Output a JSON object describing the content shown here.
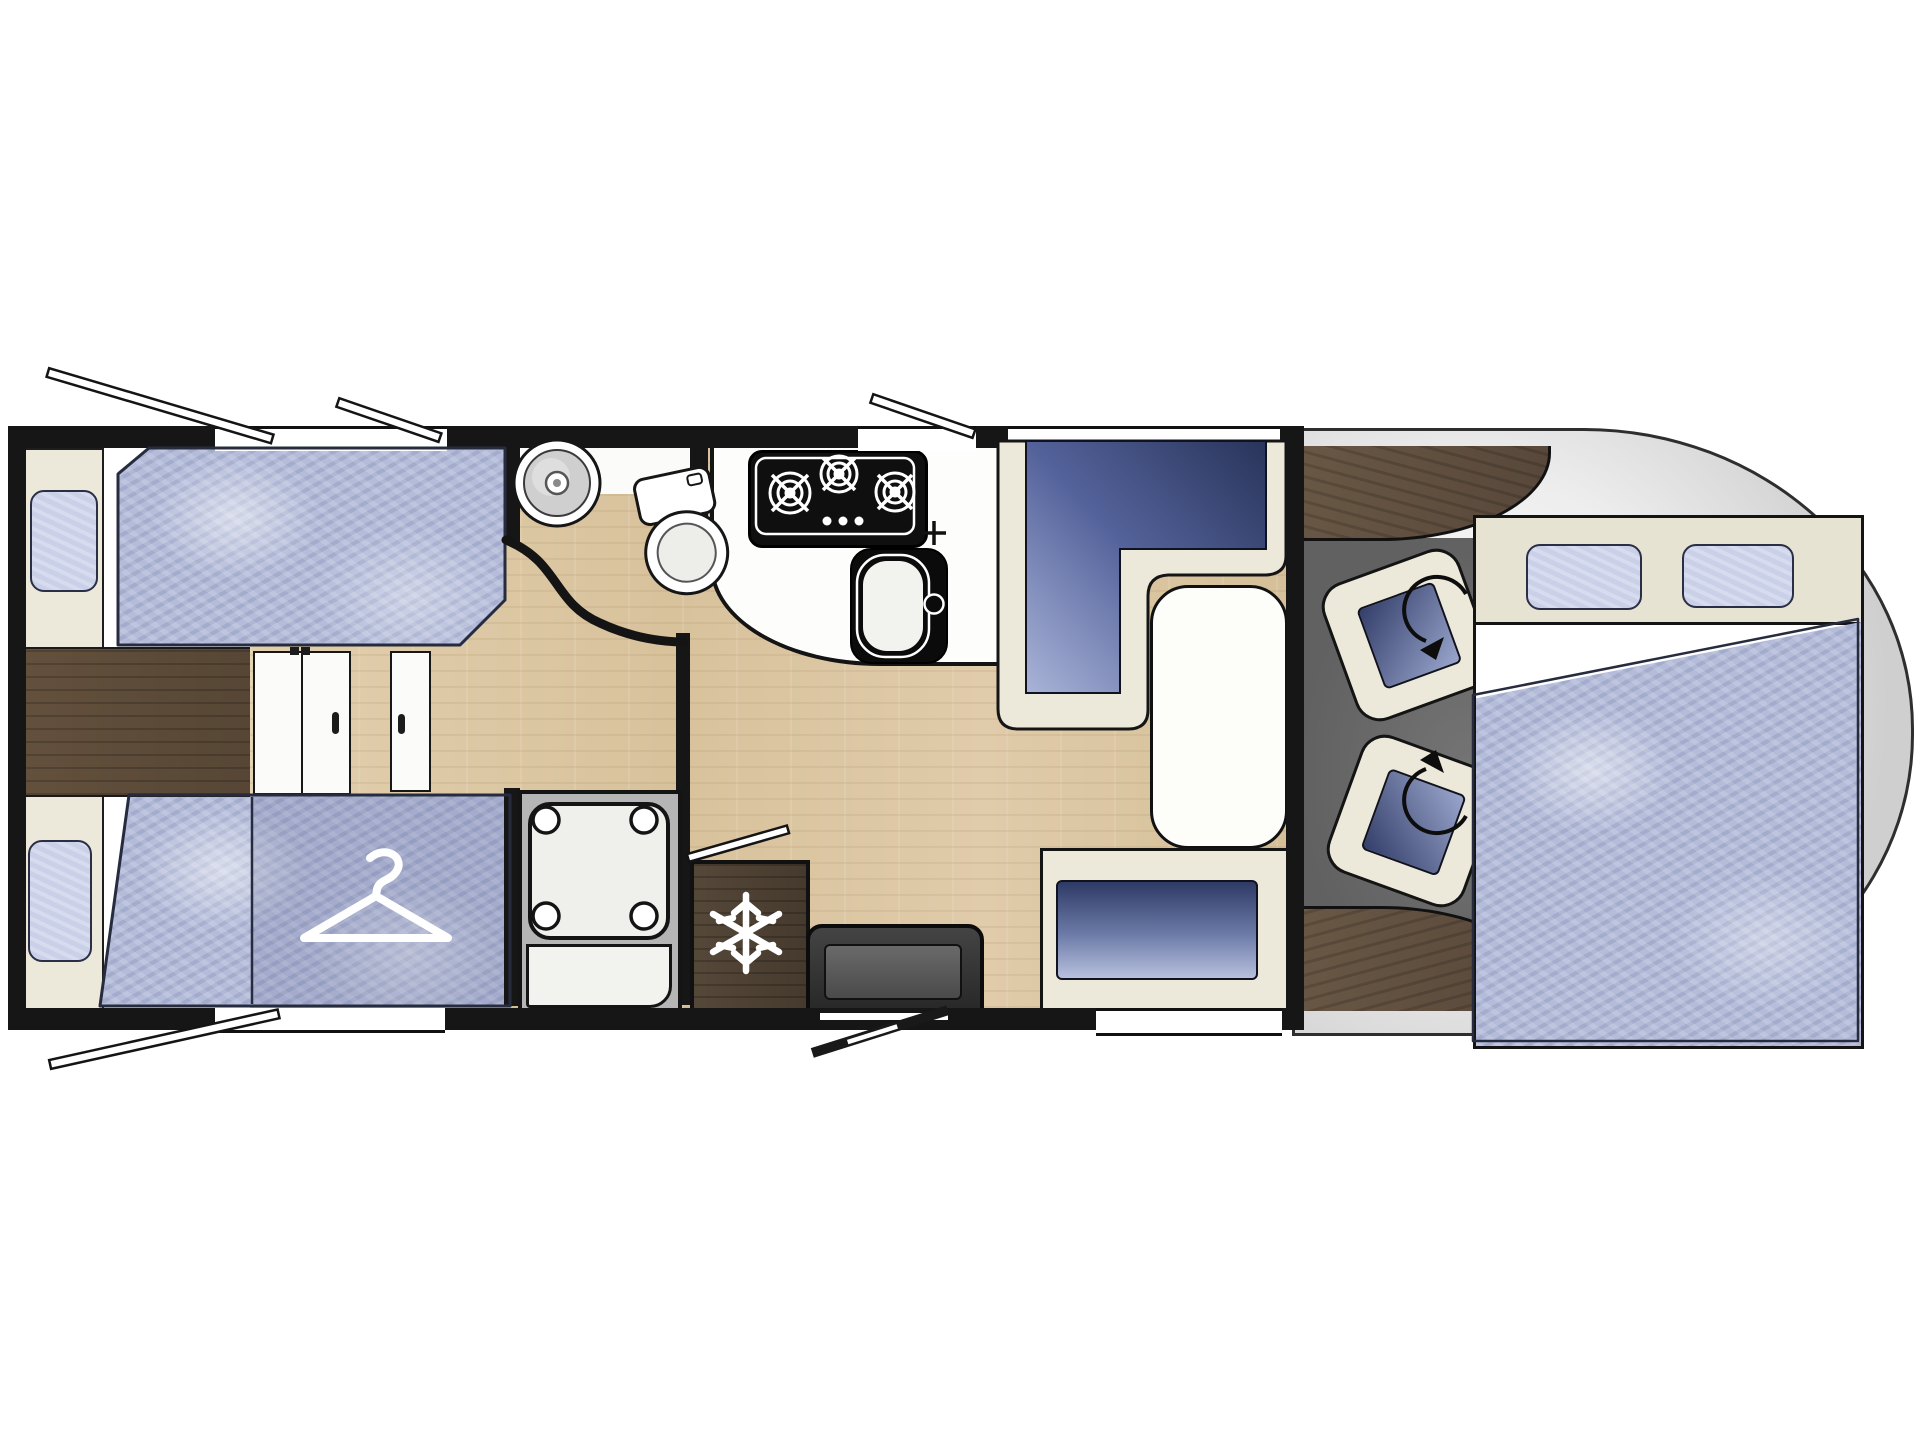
{
  "title": "Motorhome floor plan (top view)",
  "diagram_type": "vehicle-floorplan",
  "visible_text": [],
  "palette": {
    "wall": "#161616",
    "outline": "#2e2e2e",
    "interior": "#ffffff",
    "cream": "#ece9db",
    "beige": "#e7e3d3",
    "mattress": "#b4bcda",
    "mattress_light": "#c9d0e8",
    "cushion_dark": "#2b3762",
    "cushion_light": "#9aa5cc",
    "wood_light": "#dcc7a4",
    "wood_dark": "#5d4d3b",
    "wood_fridge": "#4c4033",
    "cab_floor": "#6b6b6b",
    "cab_body": "#ededed",
    "fixture": "#fbfbf9",
    "hob": "#0f0f0f",
    "entry_door": "#343434",
    "icon": "#ffffff"
  },
  "vehicle": {
    "orientation": "front-of-vehicle-right, rear-left",
    "rear_bedroom": {
      "single_beds": 2,
      "pillows": 2,
      "features": [
        "single-bed-top",
        "single-bed-bottom",
        "center-walkway",
        "bi-fold-door",
        "side-door-panel",
        "wardrobe-under-foot-of-bed"
      ],
      "icons": [
        "hanger-icon"
      ]
    },
    "washroom": {
      "features": [
        "round-washbasin",
        "swivel-toilet",
        "curved-partition-wall"
      ]
    },
    "shower": {
      "features": [
        "square-shower-tray-with-corner-posts"
      ]
    },
    "kitchen": {
      "hob_burners": 3,
      "features": [
        "three-burner-hob",
        "kitchen-sink-with-tap",
        "curved-worktop",
        "refrigerator"
      ],
      "icons": [
        "burner-icon",
        "snowflake-icon",
        "faucet-cross-icon"
      ]
    },
    "dinette": {
      "features": [
        "l-shaped-seat-bench",
        "pedestal-table",
        "side-bench-seat"
      ]
    },
    "entry": {
      "features": [
        "entrance-door",
        "door-swing-indicator",
        "threshold"
      ]
    },
    "cab": {
      "swivel_seats": 2,
      "features": [
        "driver-swivel-seat",
        "passenger-swivel-seat",
        "dashboard-top",
        "dashboard-bottom",
        "cab-floor"
      ],
      "icons": [
        "rotation-arrow-icon"
      ]
    },
    "front_bed": {
      "features": [
        "drop-down-bed",
        "headboard-shelf"
      ],
      "pillows": 2
    },
    "openings": {
      "open_window_struts": 5,
      "top_wall_windows": 3,
      "bottom_wall_windows": 2,
      "entry_doors": 1
    }
  }
}
